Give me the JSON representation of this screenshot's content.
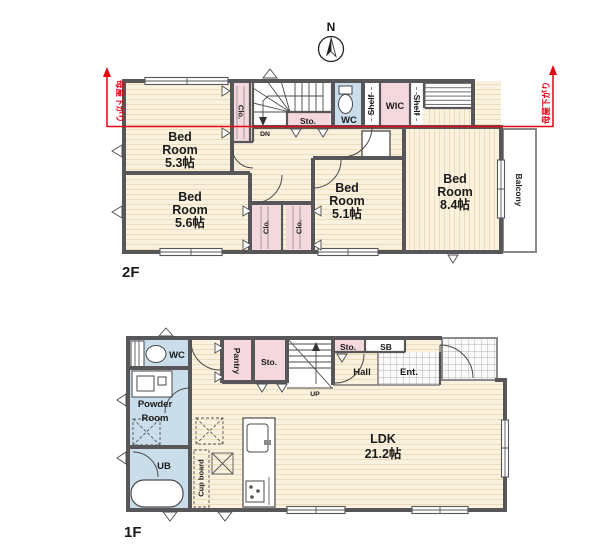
{
  "compass": {
    "north": "N"
  },
  "colors": {
    "wall": "#57575A",
    "floor_cream": "#FAF1DE",
    "closet_pink": "#F4D8DE",
    "wet_blue": "#C9DDEB",
    "roof_note_red": "#E60012"
  },
  "floor2": {
    "label": "2F",
    "roof_note_left": "母屋下がり",
    "roof_note_right": "母屋下がり",
    "bedroom1": {
      "l1": "Bed",
      "l2": "Room",
      "size": "5.3帖"
    },
    "bedroom2": {
      "l1": "Bed",
      "l2": "Room",
      "size": "5.6帖"
    },
    "bedroom3": {
      "l1": "Bed",
      "l2": "Room",
      "size": "5.1帖"
    },
    "bedroom4": {
      "l1": "Bed",
      "l2": "Room",
      "size": "8.4帖"
    },
    "closet_top": "Clo.",
    "closet_left": "Clo.",
    "closet_right": "Clo.",
    "storage": "Sto.",
    "wc": "WC",
    "shelf_left": "Shelf",
    "wic": "WIC",
    "shelf_right": "Shelf",
    "balcony": "Balcony",
    "stairs_dn": "DN"
  },
  "floor1": {
    "label": "1F",
    "wc": "WC",
    "powder_room": {
      "l1": "Powder",
      "l2": "Room"
    },
    "ub": "UB",
    "pantry": "Pantry",
    "storage_kitchen": "Sto.",
    "storage_hall": "Sto.",
    "shoe_box": "SB",
    "hall": "Hall",
    "entrance": "Ent.",
    "ldk": {
      "l1": "LDK",
      "size": "21.2帖"
    },
    "cupboard": "Cup board",
    "stairs_up": "UP"
  }
}
